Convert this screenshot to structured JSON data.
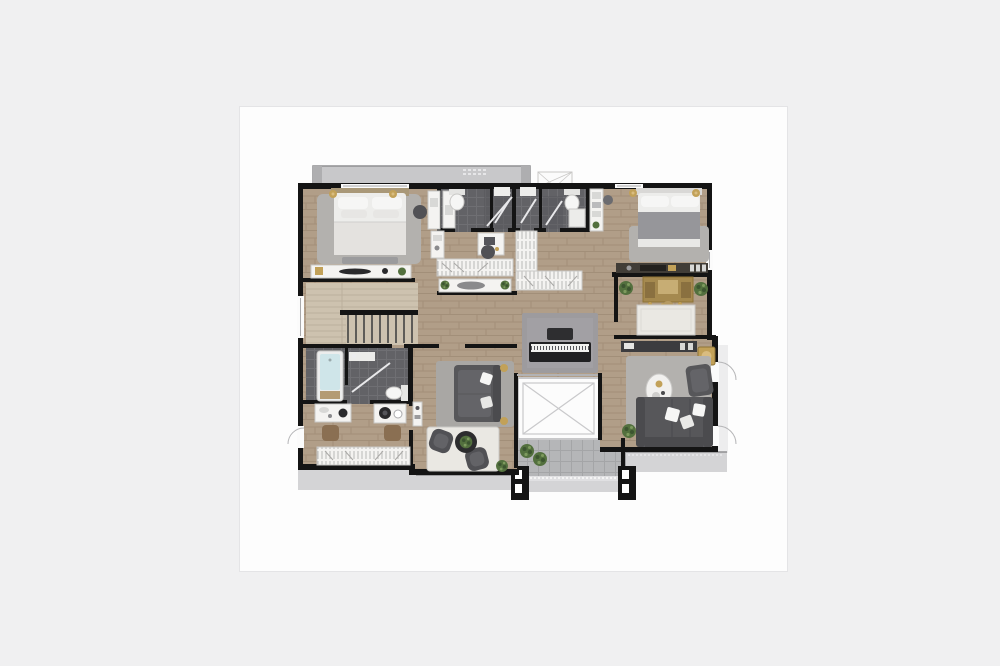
{
  "scene": {
    "type": "floor-plan-rendering",
    "view": "top-down",
    "visible_text": "none"
  },
  "palette": {
    "bg": "#f0f0f1",
    "card": "#fdfdfd",
    "cardBorder": "#e4e4e6",
    "wall": "#141414",
    "wood": "#b19e88",
    "woodLine": "#a28f79",
    "woodLight": "#cdc2af",
    "tile": "#626266",
    "tileLine": "#6f6f73",
    "tileDark": "#57575b",
    "balcTop": "#c8c8ca",
    "balc": "#b5b6b8",
    "walk": "#d4d4d6",
    "white": "#f4f3f1",
    "rugGray": "#b3b1ae",
    "rugWhite": "#eae8e3",
    "rugDark": "#9d9b9e",
    "sofa": "#57575a",
    "sofaDark": "#4b4b4e",
    "sofaLight": "#646468",
    "bedWhite": "#ededeb",
    "blanket": "#96969a",
    "headboard": "#a99878",
    "gold": "#c2a158",
    "goldDark": "#8f7436",
    "green": "#53703e",
    "greenDark": "#3c5530",
    "tub": "#cfe5e9",
    "stool": "#8a6f52",
    "consoleDark": "#413d37",
    "vanityGold": "#a5894f",
    "piano": "#202022",
    "keys": "#f1f1ef",
    "elev": "#fcfcfc",
    "chair": "#515155"
  },
  "rooms": [
    {
      "id": "bedroom-1"
    },
    {
      "id": "bathroom-1"
    },
    {
      "id": "shower-wc-1"
    },
    {
      "id": "shower-wc-2"
    },
    {
      "id": "bathroom-2"
    },
    {
      "id": "bedroom-2"
    },
    {
      "id": "walkin-closet-hall"
    },
    {
      "id": "dressing-area"
    },
    {
      "id": "living-room"
    },
    {
      "id": "staircase"
    },
    {
      "id": "bathroom-3"
    },
    {
      "id": "vanity-room"
    },
    {
      "id": "media-lounge"
    },
    {
      "id": "piano-corner"
    },
    {
      "id": "elevator"
    },
    {
      "id": "balcony-top"
    },
    {
      "id": "balcony-bottom"
    },
    {
      "id": "balcony-right"
    }
  ]
}
